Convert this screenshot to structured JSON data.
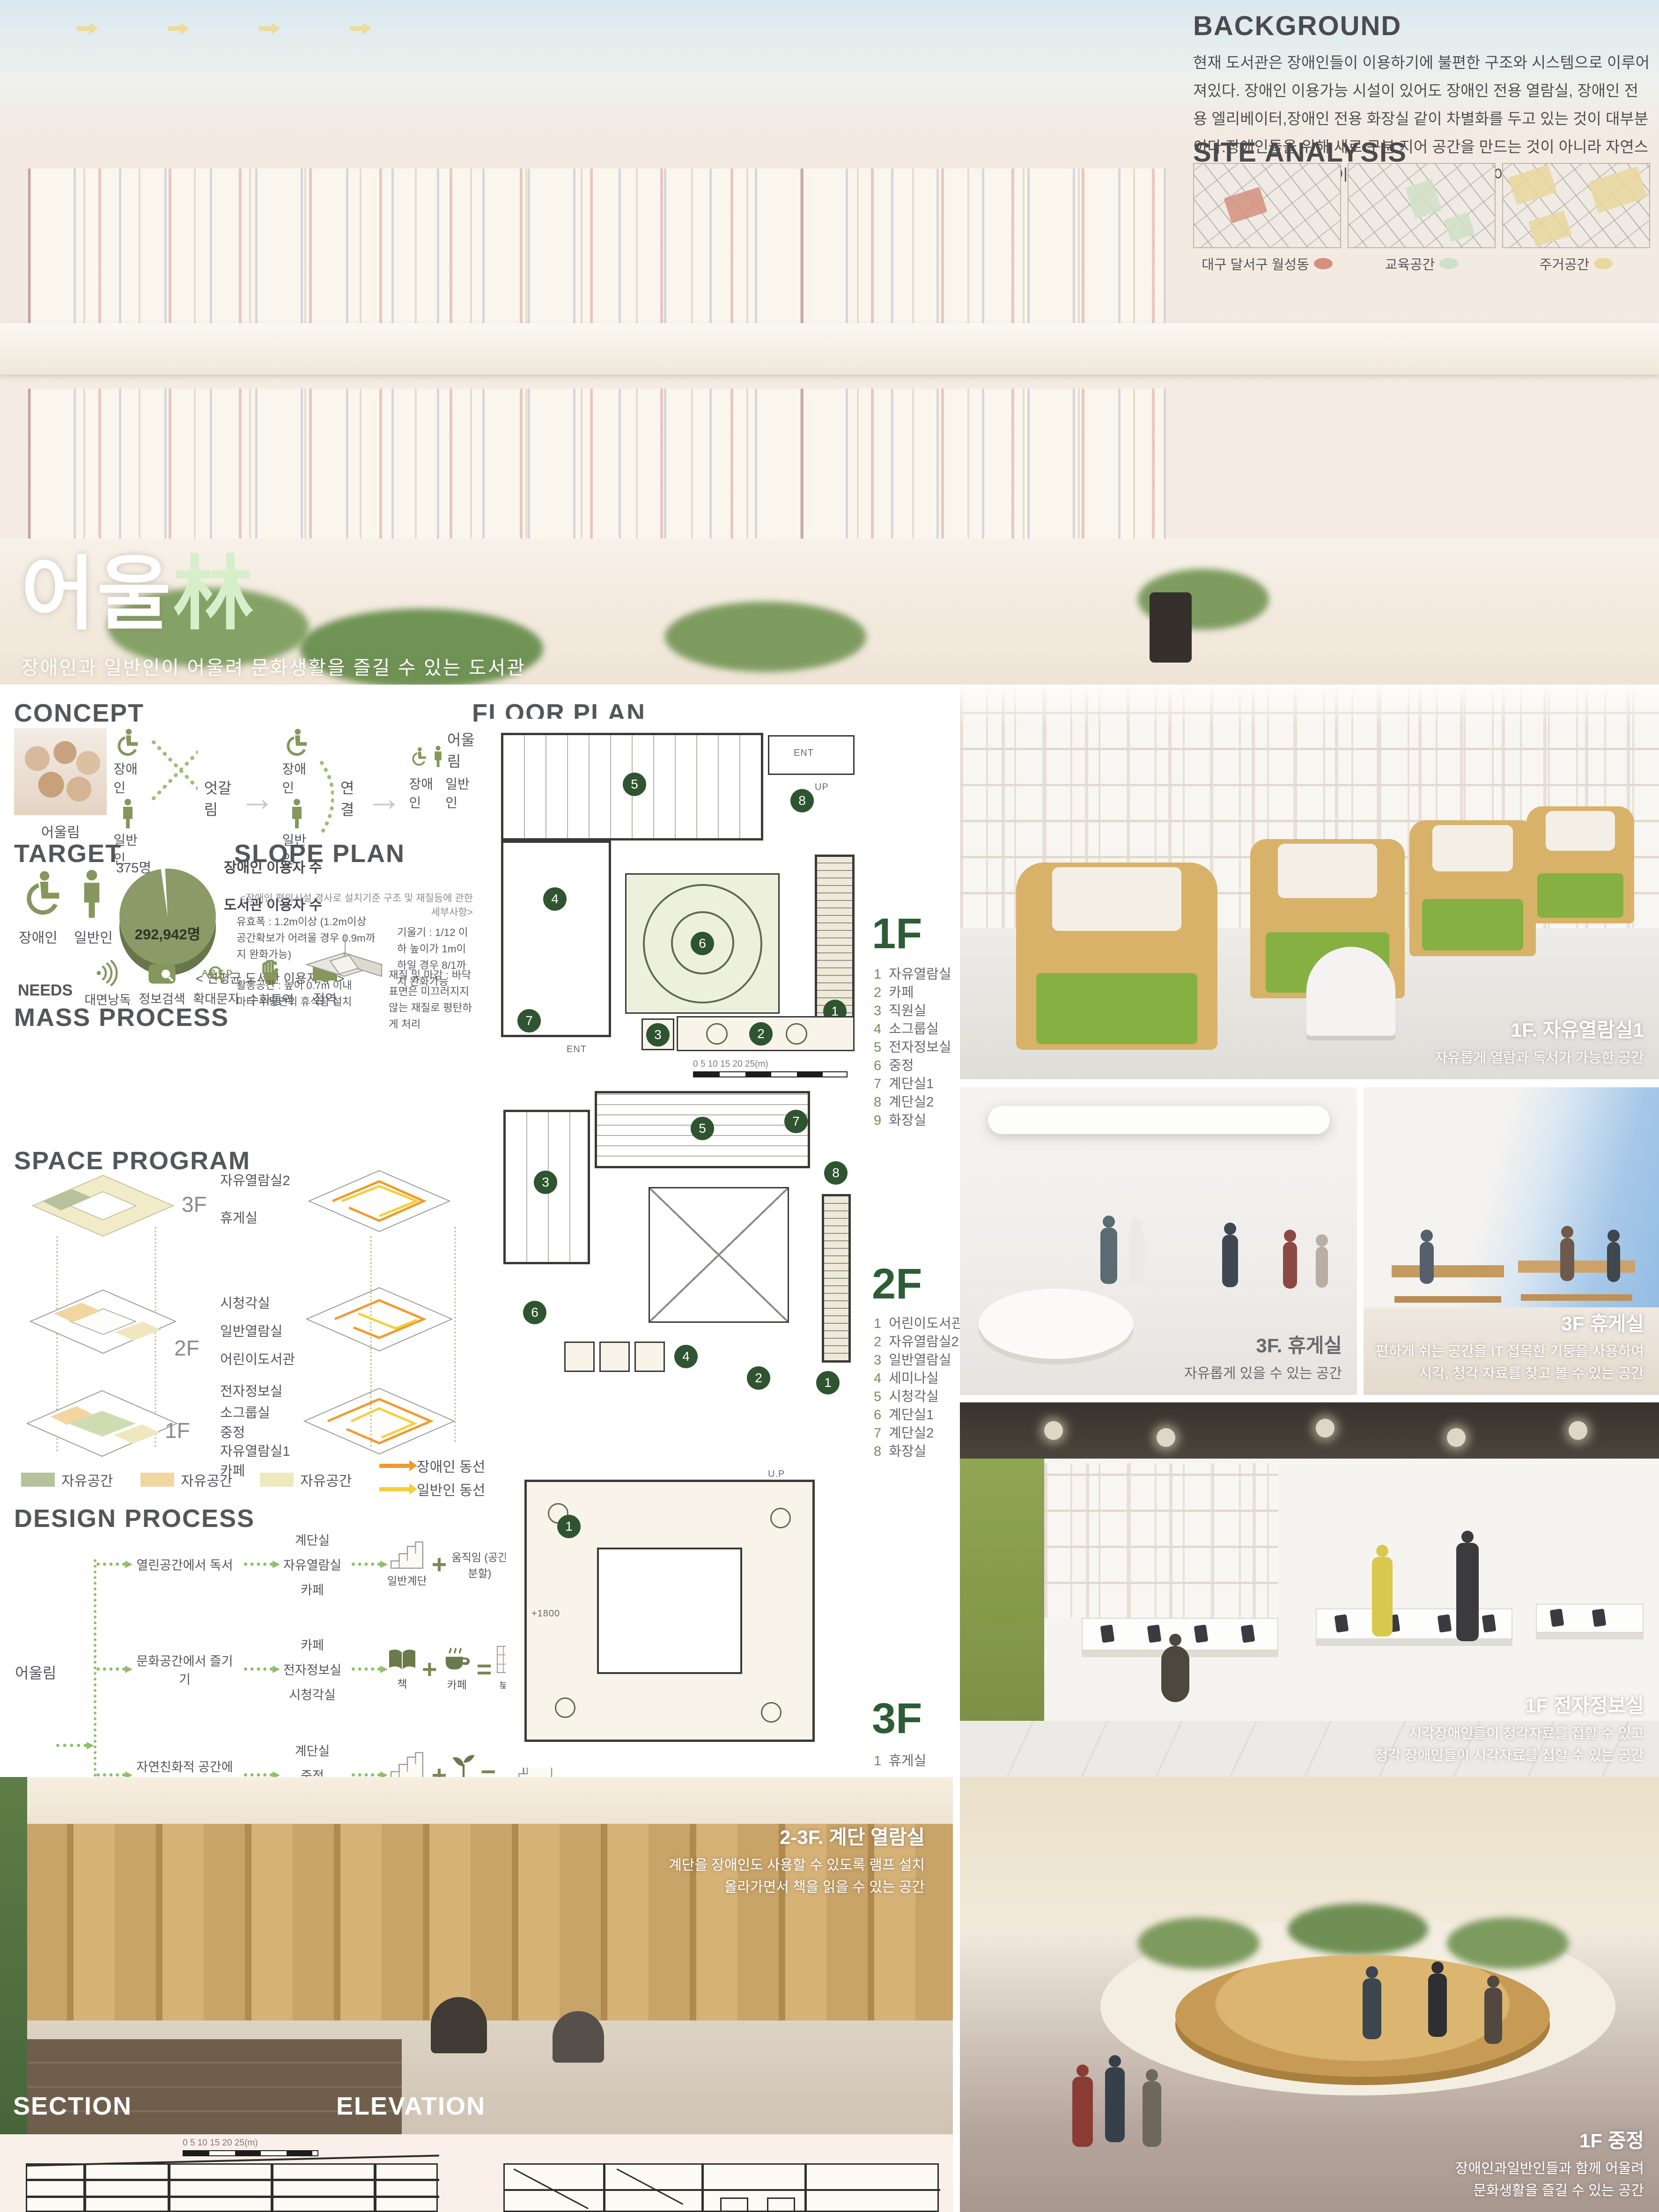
{
  "poster": {
    "title_ko": "어울",
    "title_hanja": "林",
    "subtitle": "장애인과 일반인이 어울려 문화생활을 즐길 수 있는 도서관"
  },
  "background": {
    "heading": "BACKGROUND",
    "body": "현재 도서관은 장애인들이 이용하기에 불편한 구조와 시스템으로 이루어져있다. 장애인 이용가능 시설이 있어도 장애인 전용 열람실, 장애인 전용 엘리베이터,장애인 전용 화장실 같이 차별화를 두고 있는 것이 대부분이다.장애인들을 위해 새로 구분 지어 공간을 만드는 것이 아니라 자연스럽게 일반 사람들과 몸이 불편한 장애인이 함께 이용이 편리한 도서관을 계획하고자 한다."
  },
  "site_analysis": {
    "heading": "SITE ANALYSIS",
    "maps": [
      {
        "label": "대구 달서구 월성동",
        "dot": "#d4907e"
      },
      {
        "label": "교육공간",
        "dot": "#cfe0c8"
      },
      {
        "label": "주거공간",
        "dot": "#e8d79e"
      }
    ]
  },
  "concept": {
    "heading": "CONCEPT",
    "photo_caption": "어울림",
    "disabled": "장애인",
    "general": "일반인",
    "stage1_label": "엇갈림",
    "stage2_label": "연결",
    "stage3_label": "어울림"
  },
  "target": {
    "heading": "TARGET",
    "icon_labels": [
      "장애인",
      "일반인"
    ],
    "pie": {
      "small_value": "375명",
      "label1": "장애인 이용자 수",
      "label2": "도서관 이용자 수",
      "big_value": "292,942명",
      "caption": "< 연평균 도서관 이용자 수 >"
    },
    "needs_label": "NEEDS",
    "needs": [
      "대면낭독",
      "정보검색",
      "확대문자",
      "수화통역",
      "점역"
    ]
  },
  "slope_plan": {
    "heading": "SLOPE PLAN",
    "subtitle": "<장애인  편의시설 경사로 설치기준 구조 및 재질등에 관한 세부사항>",
    "notes": [
      "유효폭 : 1.2m이상 (1.2m이상 공간확보가 어려울 경우 0.9m까지 완화가능)",
      "기울기 : 1/12 이하 높이가 1m이하일 경우 8/1까지 완화가능",
      "활동공간 : 높이 0.7m 이내마다 수평면의 휴식참 설치",
      "재질 및 마감 : 바닥표면은 미끄러지지 않는 재질로 평탄하게 처리"
    ]
  },
  "mass_process": {
    "heading": "MASS PROCESS",
    "steps": [
      "MASS",
      "중정형성",
      "루프선",
      "면으로 변화",
      "엇갈리게 공간 형성"
    ]
  },
  "space_program": {
    "heading": "SPACE PROGRAM",
    "f3": "3F",
    "f2": "2F",
    "f1": "1F",
    "labels3": [
      "자유열람실2",
      "휴게실"
    ],
    "labels2": [
      "시청각실",
      "일반열람실",
      "어린이도서관"
    ],
    "labels1": [
      "전자정보실",
      "소그룹실",
      "중정",
      "자유열람실1",
      "카페"
    ],
    "legend": [
      "자유공간",
      "자유공간",
      "자유공간"
    ],
    "circ1": "장애인 동선",
    "circ2": "일반인 동선"
  },
  "design_process": {
    "heading": "DESIGN PROCESS",
    "root": "어울림",
    "rows": [
      {
        "activity": "열린공간에서 독서",
        "spaces": [
          "계단실",
          "자유열람실",
          "카페"
        ],
        "a": "일반계단",
        "b": "움직임 (공간 분할)",
        "r": "엇갈리는 층"
      },
      {
        "activity": "문화공간에서 즐기기",
        "spaces": [
          "카페",
          "전자정보실",
          "시청각실"
        ],
        "a": "책",
        "b": "카페",
        "r": "북카페"
      },
      {
        "activity": "자연친화적 공간에서 휴식하기",
        "spaces": [
          "계단실",
          "중정",
          "휴게실"
        ],
        "a": "일반계단",
        "b": "식물",
        "r": "자연친화적계단"
      },
      {
        "activity": "",
        "spaces": [],
        "a": "MASS",
        "b": "식물",
        "r": "중정"
      },
      {
        "activity": "휴게공간에서 IT즐기기",
        "spaces": [
          "휴게실"
        ],
        "a": "기둥",
        "b": "컴퓨터",
        "r": "옥상휴게실"
      }
    ]
  },
  "floor_plan": {
    "heading": "FLOOR PLAN",
    "f1": {
      "label": "1F",
      "badges": [
        "1",
        "2",
        "3",
        "4",
        "5",
        "6",
        "7",
        "8",
        "9"
      ],
      "legend": [
        "자유열람실",
        "카페",
        "직원실",
        "소그룹실",
        "전자정보실",
        "중정",
        "계단실1",
        "계단실2",
        "화장실"
      ]
    },
    "f2": {
      "label": "2F",
      "badges": [
        "1",
        "2",
        "3",
        "4",
        "5",
        "6",
        "7",
        "8"
      ],
      "legend": [
        "어린이도서관",
        "자유열람실2",
        "일반열람실",
        "세미나실",
        "시청각실",
        "계단실1",
        "계단실2",
        "화장실"
      ]
    },
    "f3": {
      "label": "3F",
      "badges": [
        "1"
      ],
      "legend": [
        "휴게실"
      ]
    },
    "ann": {
      "ent": "ENT",
      "up": "UP",
      "up2": "U.P",
      "lvl": "+1800"
    },
    "scale_text": "0      5      10      15      20      25(m)"
  },
  "photos": {
    "reading_room": {
      "title": "1F. 자유열람실1",
      "lines": [
        "자유롭게 열람과 독서가 가능한 공간"
      ]
    },
    "lounge_a": {
      "title": "3F. 휴게실",
      "lines": [
        "자유롭게 있을 수 있는 공간"
      ]
    },
    "lounge_b": {
      "title": "3F 휴게실",
      "lines": [
        "편하게 쉬는 공간을 IT 접목한 기둥을 사용하여",
        "시각, 청각 자료를 찾고 볼 수 있는 공간"
      ]
    },
    "digital": {
      "title": "1F 전자정보실",
      "lines": [
        "시각장애인들이 청각자료를 접할 수 있고",
        "청각 장애인들이 시각자료를 접할 수 있는 공간"
      ]
    },
    "stair": {
      "title": "2-3F. 계단 열람실",
      "lines": [
        "계단을 장애인도 사용할 수 있도록 램프 설치",
        "올라가면서 책을 읽을 수 있는 공간"
      ]
    },
    "courtyard": {
      "title": "1F 중정",
      "lines": [
        "장애인과일반인들과 함께 어울려",
        "문화생활을 즐길 수 있는 공간"
      ]
    }
  },
  "section_elevation": {
    "section": "SECTION",
    "elevation": "ELEVATION",
    "scale_text": "0      5      10      15      20      25(m)"
  }
}
